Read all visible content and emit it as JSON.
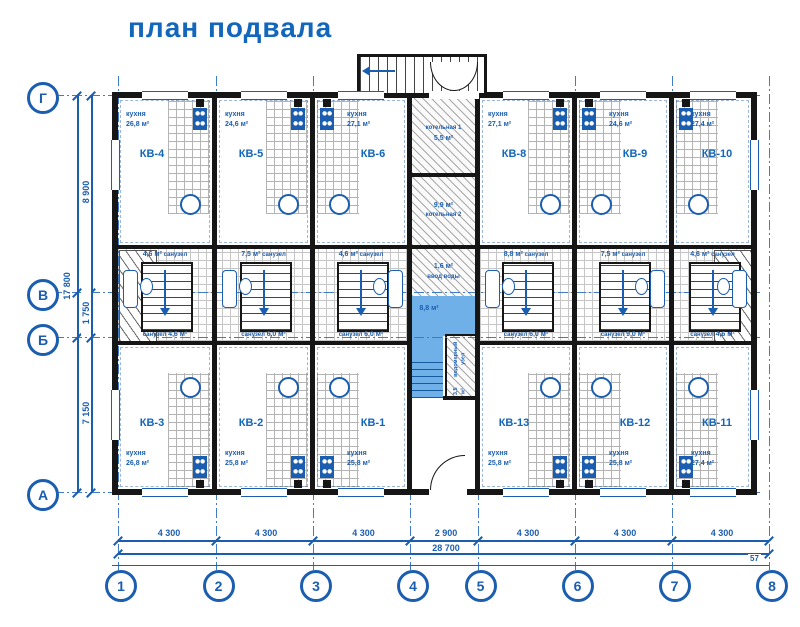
{
  "title": "план подвала",
  "colors": {
    "line_blue": "#1b5eb0",
    "title_blue": "#1266bb",
    "fill_blue": "#6fb0e8",
    "wall_black": "#161616"
  },
  "axes": {
    "rows": [
      "Г",
      "В",
      "Б",
      "А"
    ],
    "cols": [
      "1",
      "2",
      "3",
      "4",
      "5",
      "6",
      "7",
      "8"
    ]
  },
  "dimensions": {
    "bottom_segments": [
      "4 300",
      "4 300",
      "4 300",
      "2 900",
      "4 300",
      "4 300",
      "4 300"
    ],
    "bottom_total": "28 700",
    "bottom_note": "57",
    "left_segments": [
      "8 900",
      "1 750",
      "7 150"
    ],
    "left_total": "17 800"
  },
  "apartments": [
    {
      "id": "КВ-4",
      "room": "кухня",
      "area": "26,8 м²"
    },
    {
      "id": "КВ-5",
      "room": "кухня",
      "area": "24,6 м²"
    },
    {
      "id": "КВ-6",
      "room": "кухня",
      "area": "27,1 м²"
    },
    {
      "id": "КВ-8",
      "room": "кухня",
      "area": "27,1 м²"
    },
    {
      "id": "КВ-9",
      "room": "кухня",
      "area": "24,6 м²"
    },
    {
      "id": "КВ-10",
      "room": "кухня",
      "area": "27,4 м²"
    },
    {
      "id": "КВ-3",
      "room": "кухня",
      "area": "26,8 м²"
    },
    {
      "id": "КВ-2",
      "room": "кухня",
      "area": "25,8 м²"
    },
    {
      "id": "КВ-1",
      "room": "кухня",
      "area": "25,8 м²"
    },
    {
      "id": "КВ-13",
      "room": "кухня",
      "area": "25,8 м²"
    },
    {
      "id": "КВ-12",
      "room": "кухня",
      "area": "25,8 м²"
    },
    {
      "id": "КВ-11",
      "room": "кухня",
      "area": "27,4 м²"
    }
  ],
  "core_rooms": [
    {
      "pos": "top-1",
      "area": "4,6 м²",
      "label": "санузел"
    },
    {
      "pos": "top-2",
      "area": "7,5 м²",
      "label": "санузел"
    },
    {
      "pos": "top-3",
      "area": "4,6 м²",
      "label": "санузел"
    },
    {
      "pos": "top-5",
      "area": "8,8 м²",
      "label": "санузел"
    },
    {
      "pos": "top-6",
      "area": "7,5 м²",
      "label": "санузел"
    },
    {
      "pos": "top-7",
      "area": "4,6 м²",
      "label": "санузел"
    },
    {
      "pos": "bottom-1",
      "area": "4,6 м²",
      "label": "санузел"
    },
    {
      "pos": "bottom-2",
      "area": "6,0 м²",
      "label": "санузел"
    },
    {
      "pos": "bottom-3",
      "area": "6,0 м²",
      "label": "санузел"
    },
    {
      "pos": "bottom-5",
      "area": "6,0 м²",
      "label": "санузел"
    },
    {
      "pos": "bottom-6",
      "area": "9,0 м²",
      "label": "санузел"
    },
    {
      "pos": "bottom-7",
      "area": "4,6 м²",
      "label": "санузел"
    }
  ],
  "center": {
    "boiler1": {
      "label": "котельная 1",
      "area": "5,5 м²"
    },
    "boiler2": {
      "label": "котельная 2",
      "area": "9,9 м²"
    },
    "water_inlet": {
      "label": "ввод воды",
      "area": "1,6 м²"
    },
    "hall": {
      "area": "8,8 м²"
    },
    "water_meter": {
      "label": "водомерный узел",
      "area": "3,5 м²"
    }
  }
}
